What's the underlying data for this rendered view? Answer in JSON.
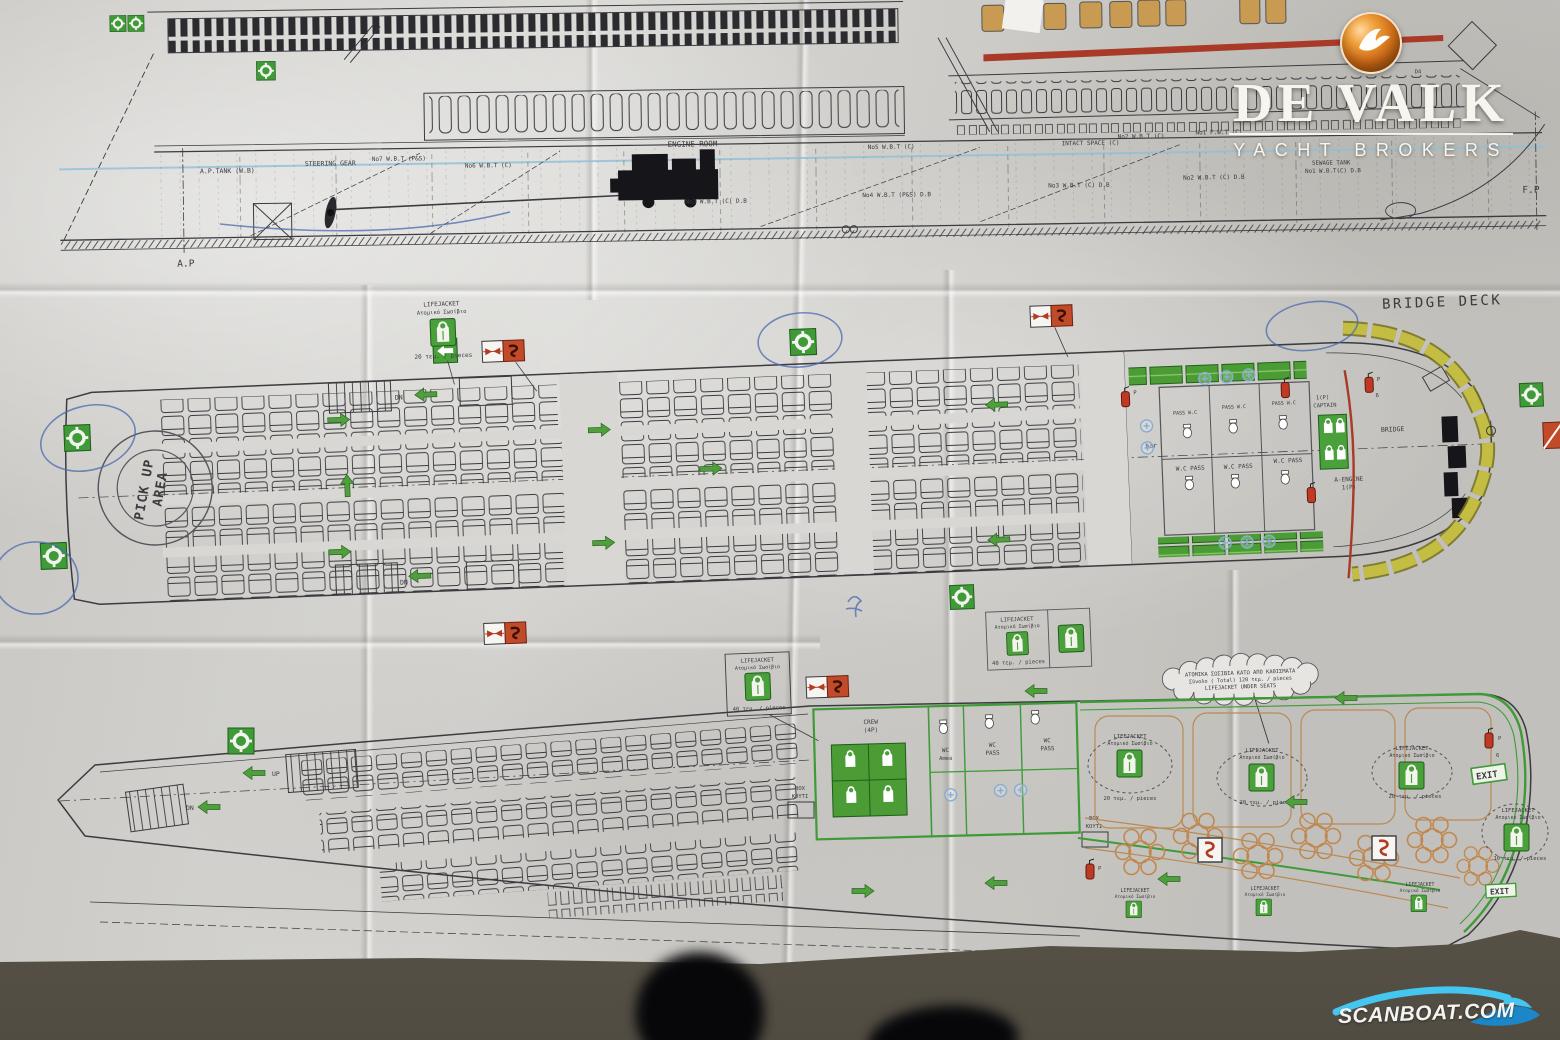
{
  "branding": {
    "broker": "DE VALK",
    "broker_sub": "YACHT BROKERS",
    "watermark": "SCANBOAT.COM"
  },
  "profile": {
    "ap_tank": "A.P.TANK (W.B)",
    "steering_gear": "STEERING GEAR",
    "no7": "No7 W.B.T (P&S)",
    "no6": "No6 W.B.T (C)",
    "engine_room": "ENGINE ROOM",
    "no5": "No5 W.B.T (C)",
    "no3_db": "No3 W.B.T (C) D.B",
    "no4_db": "No4 W.B.T (P&S) D.B",
    "intact_space": "INTACT SPACE (C)",
    "no2": "No2 W.B.T (C)",
    "no1_fwt": "No1 F.W.T (C)",
    "sewage1": "SEWAGE TANK",
    "sewage2": "No1 W.B.T(C) D.B",
    "no2_db": "No2 W.B.T (C) D.B",
    "no3_db2": "No3 W.B.T (C) D.B",
    "ap": "A.P",
    "fp": "F.P",
    "d4": "D4"
  },
  "bridge": {
    "title": "BRIDGE DECK",
    "bridge": "BRIDGE",
    "captain1": "1(P)",
    "captain2": "CAPTAIN",
    "aengine1": "A-ENGINE",
    "aengine2": "1(P)",
    "bar": "bar",
    "pass_wc": "PASS W.C",
    "wc_pass": "W.C PASS",
    "pickup1": "PICK UP",
    "pickup2": "AREA",
    "dn": "DN"
  },
  "lower": {
    "crew1": "CREW",
    "crew2": "(4P)",
    "wc": "WC",
    "amea": "Amea",
    "pass": "PASS",
    "box": "BOX",
    "kouti": "ΚΟΥΤΙ",
    "up": "UP",
    "dn": "DN",
    "exit": "EXIT"
  },
  "legend": {
    "lifejacket": "LIFEJACKET",
    "lifejacket_gr": "Ατομικό Σωσίβιο",
    "qty10": "10 τεμ. / pieces",
    "qty20": "20 τεμ. / pieces",
    "qty40": "40 τεμ. / pieces",
    "p": "P",
    "six": "6",
    "note1": "ΑΤΟΜΙΚΑ ΣΩΣΙΒΙΑ ΚΑΤΩ ΑΠΟ ΚΑΘΙΣΜΑΤΑ",
    "note2": "Σύνολο ( Total) 120 τεμ. / pieces",
    "note3": "LIFEJACKET UNDER SEATS"
  },
  "colors": {
    "safety_green": "#3e9b37",
    "fire_red": "#bf3a24",
    "raft_yellow": "#c0ba45",
    "seat_tan": "#c08850",
    "brand_orange": "#e07818",
    "watermark_blue": "#2aa9df",
    "stripe_red": "#a93a28",
    "pickup_orange": "#cf9a3e",
    "pen_blue": "#4a6ab0"
  }
}
